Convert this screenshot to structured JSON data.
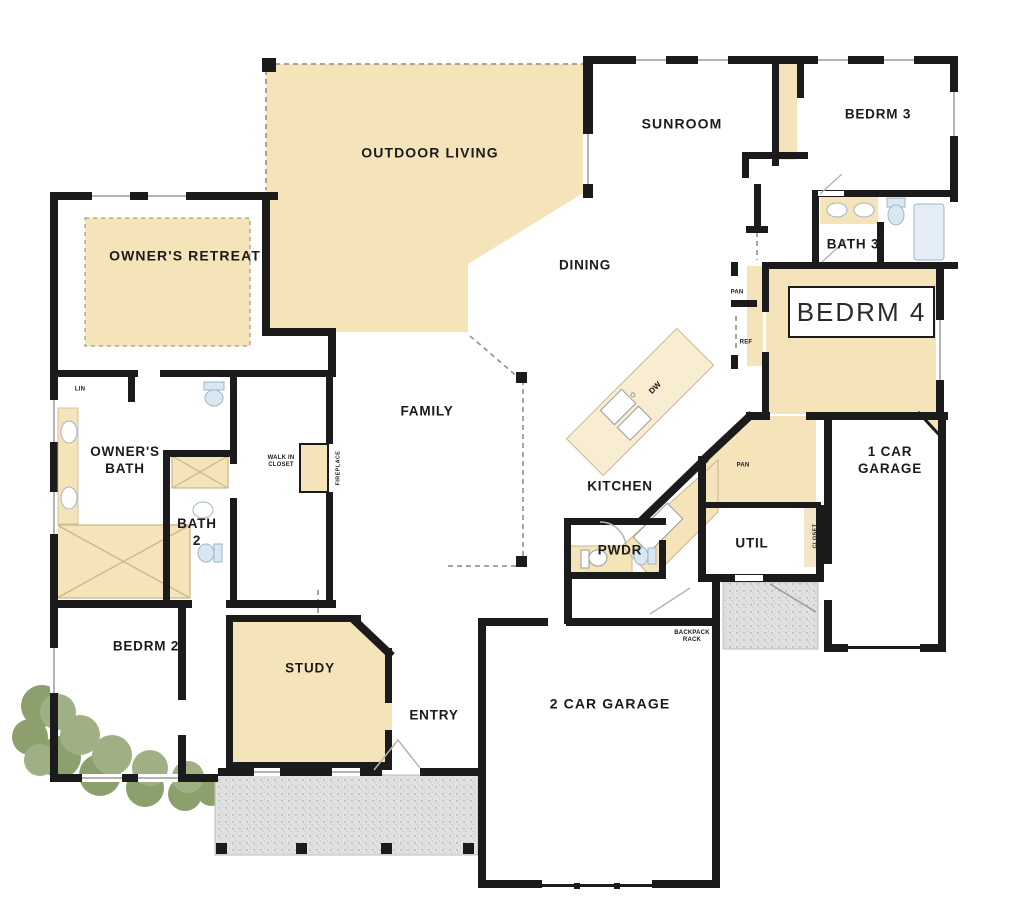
{
  "colors": {
    "wall": "#1b1b1b",
    "room_fill": "#F5E3BA",
    "island_fill": "#F8ECD3",
    "porch": "#E1E1E1",
    "bush": "#9FB184",
    "bush_dark": "#8CA06E",
    "fixture": "#D9E7F1",
    "label": "#1b1b1b",
    "highlight_box_bg": "#FFFFFF",
    "highlight_box_border": "#1b1b1b"
  },
  "rooms": {
    "outdoor_living": "OUTDOOR LIVING",
    "sunroom": "SUNROOM",
    "bedrm3": "BEDRM 3",
    "bath3": "BATH 3",
    "bedrm4": "BEDRM 4",
    "owners_retreat": "OWNER'S RETREAT",
    "dining": "DINING",
    "family": "FAMILY",
    "kitchen": "KITCHEN",
    "pwdr": "PWDR",
    "util": "UTIL",
    "one_car_garage_l1": "1 CAR",
    "one_car_garage_l2": "GARAGE",
    "owners_bath_l1": "OWNER'S",
    "owners_bath_l2": "BATH",
    "bath2_l1": "BATH",
    "bath2_l2": "2",
    "bedrm2": "BEDRM 2",
    "study": "STUDY",
    "entry": "ENTRY",
    "two_car_garage": "2 CAR GARAGE"
  },
  "fixtures_labels": {
    "lin": "LIN",
    "walk_in_closet_l1": "WALK IN",
    "walk_in_closet_l2": "CLOSET",
    "fireplace": "FIREPLACE",
    "pantry_upper": "PAN",
    "refrigerator": "REF",
    "dishwasher": "DW",
    "pantry_lower": "PAN",
    "closet": "CLOSET",
    "backpack_rack_l1": "BACKPACK",
    "backpack_rack_l2": "RACK"
  }
}
